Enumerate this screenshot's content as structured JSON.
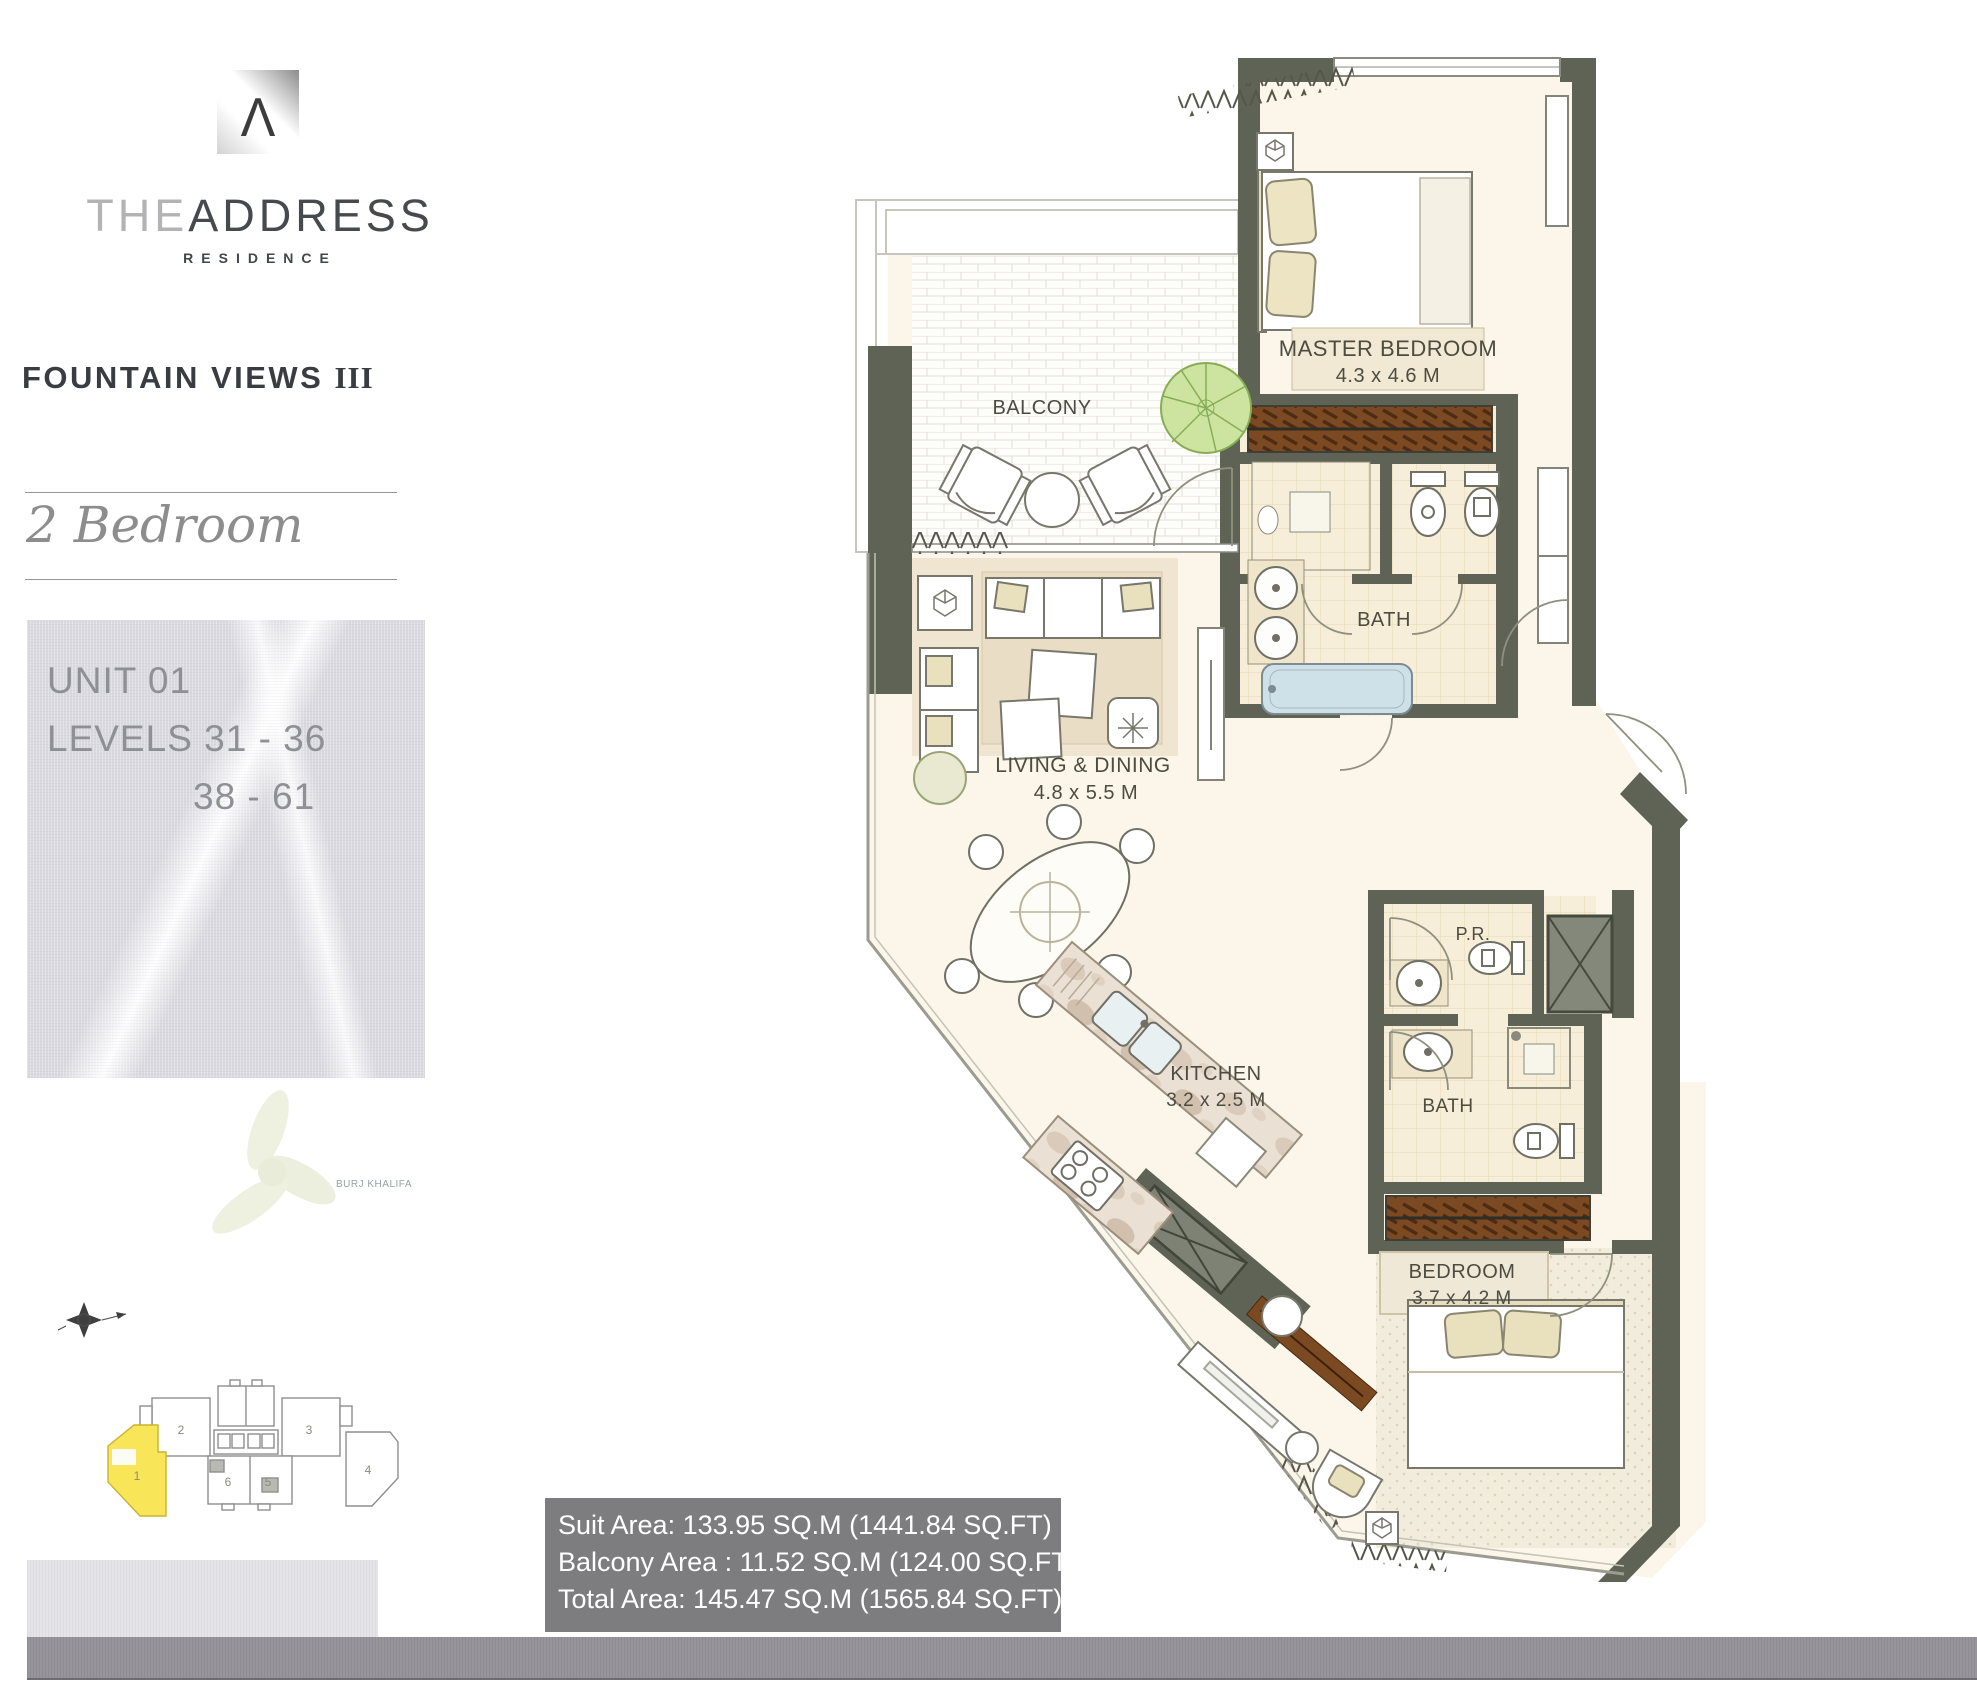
{
  "brand": {
    "logo_symbol": "Λ",
    "name_part1": "THE",
    "name_part2": "ADDRESS",
    "subtitle": "RESIDENCE"
  },
  "project": {
    "title_main": "FOUNTAIN VIEWS ",
    "title_numeral": "III",
    "unit_type_script": "2 Bedroom",
    "unit_label": "UNIT 01",
    "levels_line1": "LEVELS 31 - 36",
    "levels_line2": "38 - 61"
  },
  "landmark_label": "BURJ KHALIFA",
  "key_plan": {
    "highlighted_unit": "1",
    "unit_labels": [
      "1",
      "2",
      "3",
      "4",
      "5",
      "6"
    ],
    "highlight_color": "#f8e658"
  },
  "floor_plan": {
    "rooms": [
      {
        "name": "MASTER BEDROOM",
        "dims": "4.3 x 4.6 M"
      },
      {
        "name": "BALCONY",
        "dims": ""
      },
      {
        "name": "BATH",
        "dims": ""
      },
      {
        "name": "LIVING & DINING",
        "dims": "4.8 x 5.5 M"
      },
      {
        "name": "KITCHEN",
        "dims": "3.2 x 2.5 M"
      },
      {
        "name": "P.R.",
        "dims": ""
      },
      {
        "name": "BATH",
        "dims": ""
      },
      {
        "name": "BEDROOM",
        "dims": "3.7 x 4.2 M"
      }
    ]
  },
  "areas": {
    "suit": "Suit Area:  133.95 SQ.M (1441.84 SQ.FT)",
    "balcony": "Balcony Area : 11.52 SQ.M (124.00 SQ.FT)",
    "total": "Total Area: 145.47 SQ.M (1565.84 SQ.FT)"
  },
  "colors": {
    "wall": "#5f6355",
    "floor_cream": "#fbf6e9",
    "bath_tile": "#f6eed8",
    "wardrobe_brown": "#7b4a22",
    "tub_blue": "#cfe1e8",
    "info_box_gray": "#7d7c7e",
    "scan_band_gray": "#97949b",
    "note_box_gray": "#d9d9df"
  }
}
